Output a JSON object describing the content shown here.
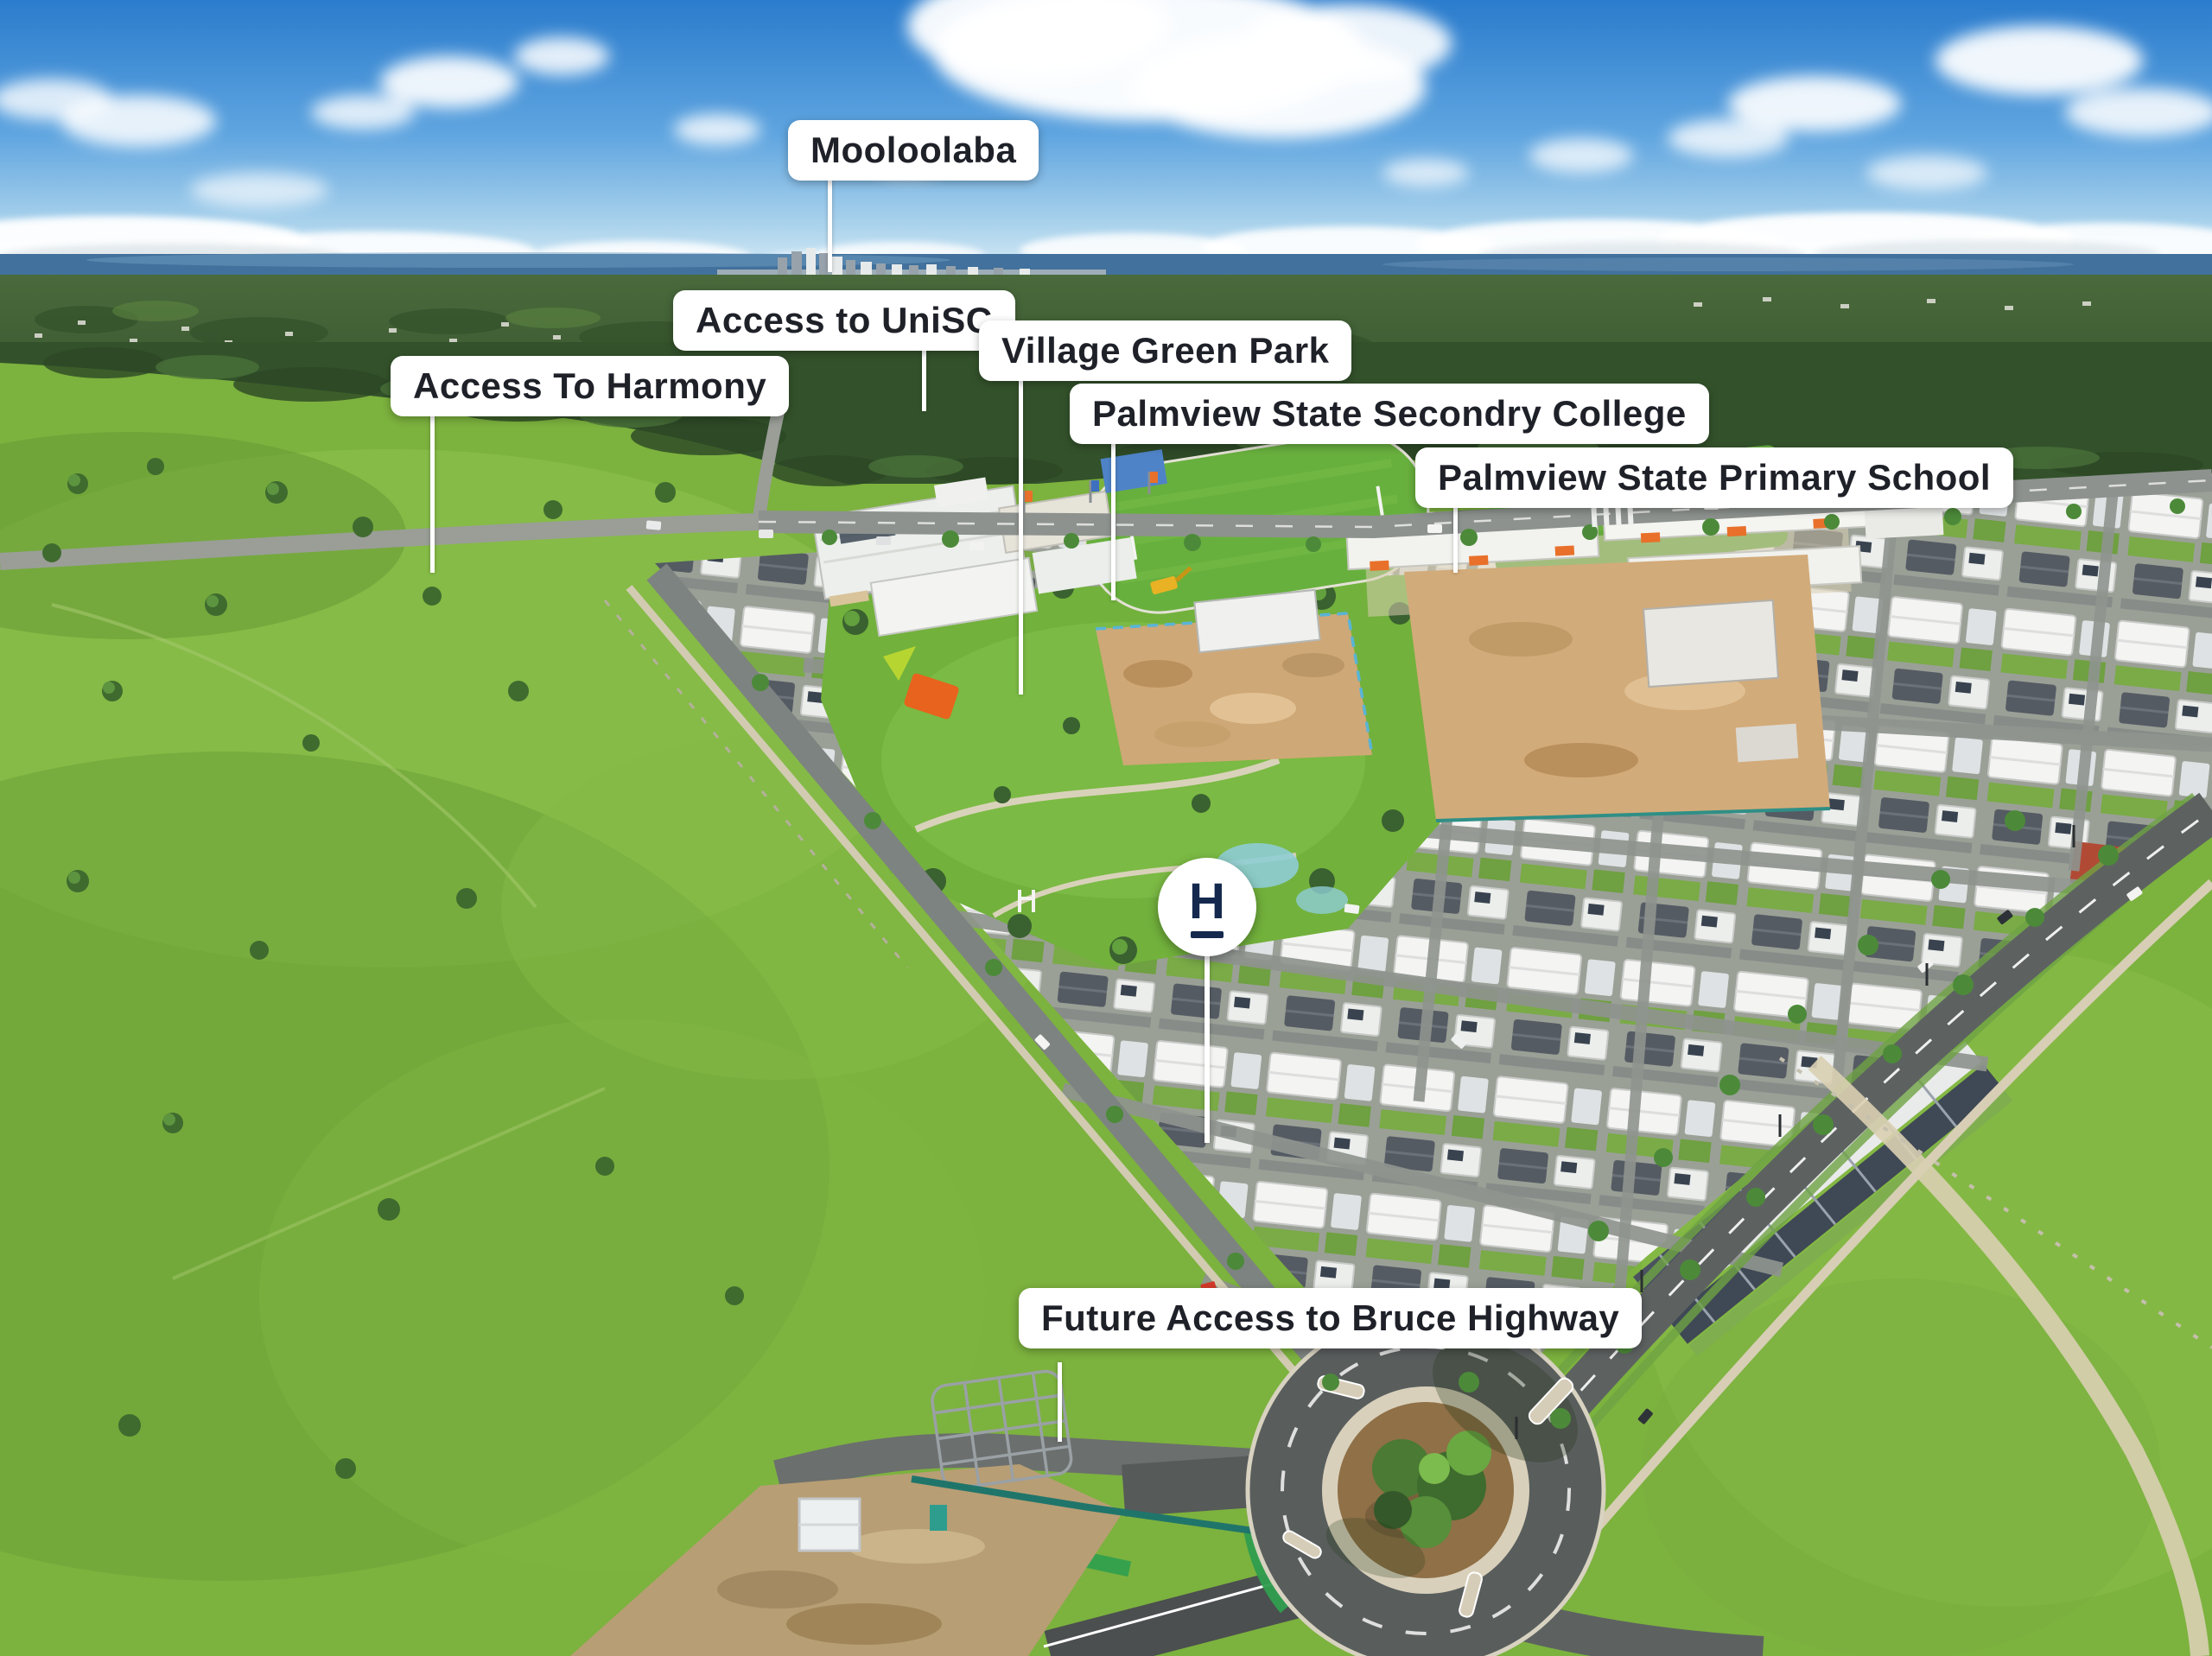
{
  "labels": [
    {
      "id": "mooloolaba",
      "text": "Mooloolaba"
    },
    {
      "id": "access-unisc",
      "text": "Access to UniSC"
    },
    {
      "id": "village-green-park",
      "text": "Village Green Park"
    },
    {
      "id": "access-harmony",
      "text": "Access To Harmony"
    },
    {
      "id": "secondary-college",
      "text": "Palmview State Secondry College"
    },
    {
      "id": "primary-school",
      "text": "Palmview State Primary School"
    },
    {
      "id": "future-access",
      "text": "Future Access to Bruce Highway"
    }
  ],
  "marker": {
    "monogram": "H"
  },
  "colors": {
    "label_background": "#ffffff",
    "label_text": "#1f2129",
    "marker_navy": "#15294e",
    "leader_line": "#ffffff",
    "sky_top": "#2b7ccd",
    "sea": "#41719c",
    "forest": "#33512b",
    "grass_field": "#7cb23e",
    "road_asphalt": "#5d6261",
    "roof_white": "#f4f4f2",
    "roof_charcoal": "#4e555e",
    "roof_red": "#b14a35",
    "construction_dirt": "#cfa877",
    "shade_sail_orange": "#e8631d",
    "shade_sail_lime": "#b7d531",
    "bike_lane_green": "#2f9e4f"
  }
}
